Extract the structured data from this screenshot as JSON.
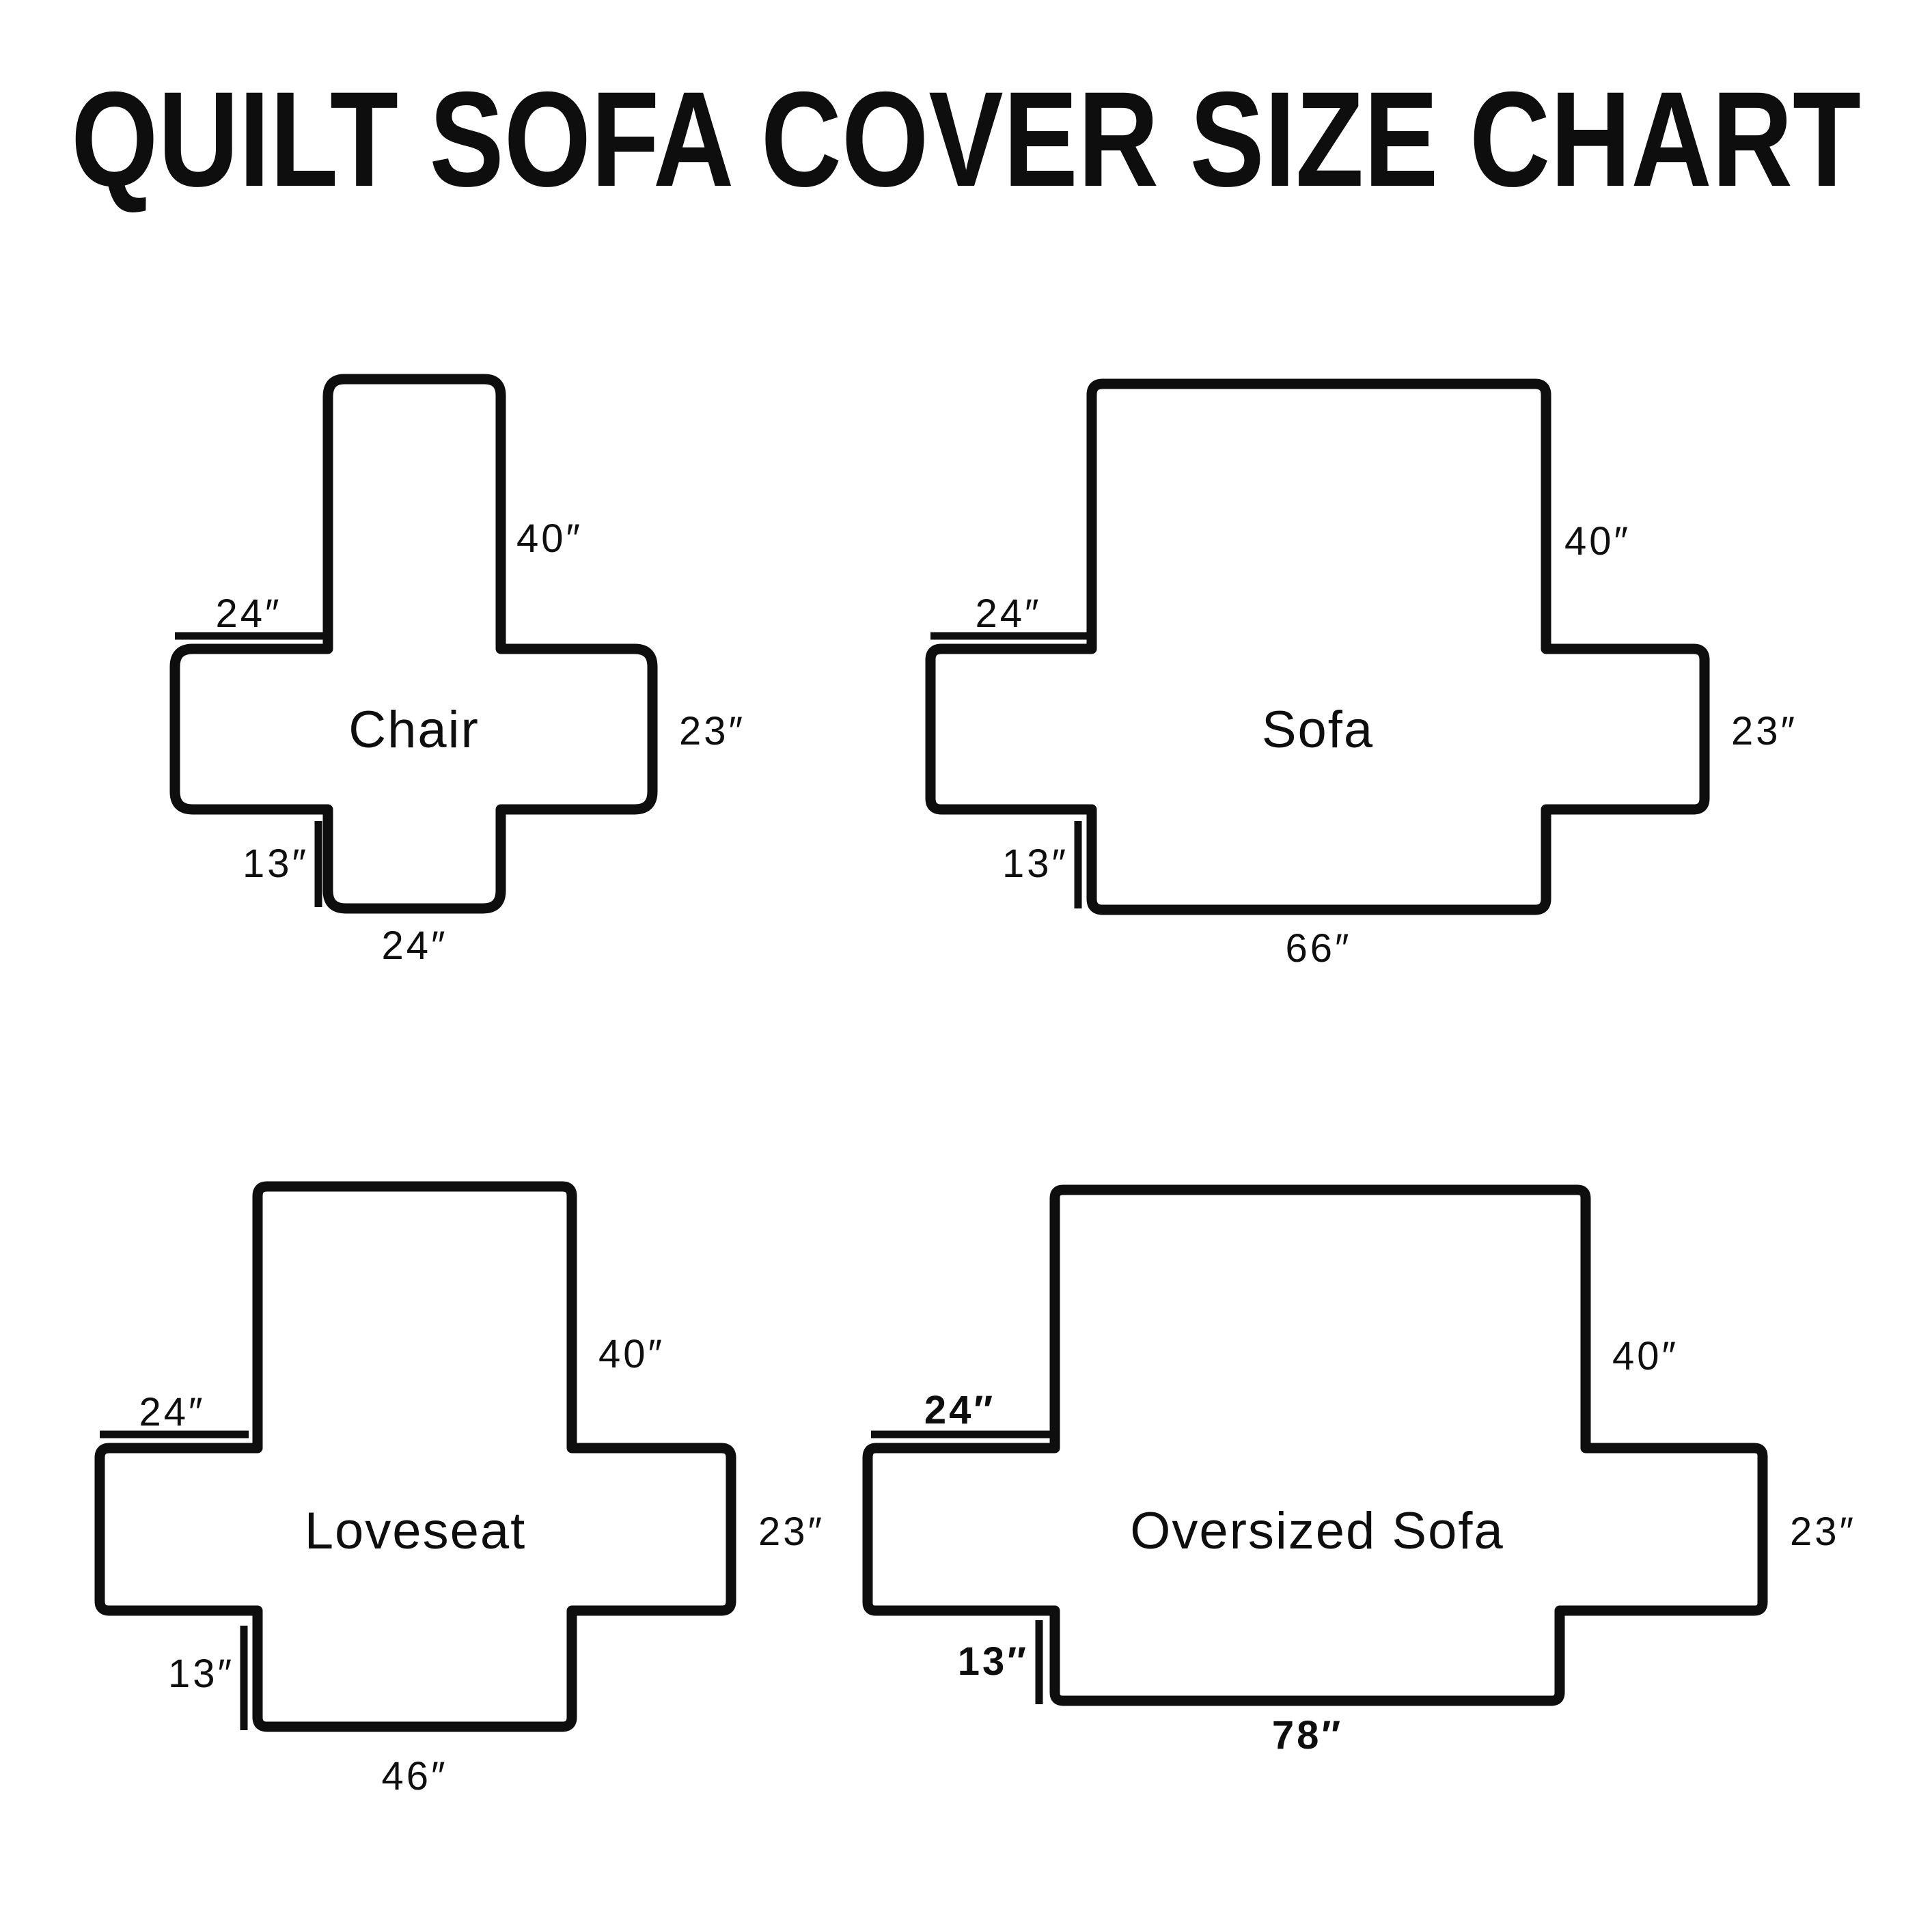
{
  "title": "QUILT SOFA COVER SIZE CHART",
  "colors": {
    "ink": "#0e0e0e",
    "background": "#ffffff"
  },
  "diagrams": [
    {
      "name": "Chair",
      "back_height": "40″",
      "arm_top_width": "24″",
      "side_height": "23″",
      "front_drop": "13″",
      "bottom_width": "24″"
    },
    {
      "name": "Sofa",
      "back_height": "40″",
      "arm_top_width": "24″",
      "side_height": "23″",
      "front_drop": "13″",
      "bottom_width": "66″"
    },
    {
      "name": "Loveseat",
      "back_height": "40″",
      "arm_top_width": "24″",
      "side_height": "23″",
      "front_drop": "13″",
      "bottom_width": "46″"
    },
    {
      "name": "Oversized Sofa",
      "back_height": "40″",
      "arm_top_width": "24″",
      "side_height": "23″",
      "front_drop": "13″",
      "bottom_width": "78″"
    }
  ]
}
